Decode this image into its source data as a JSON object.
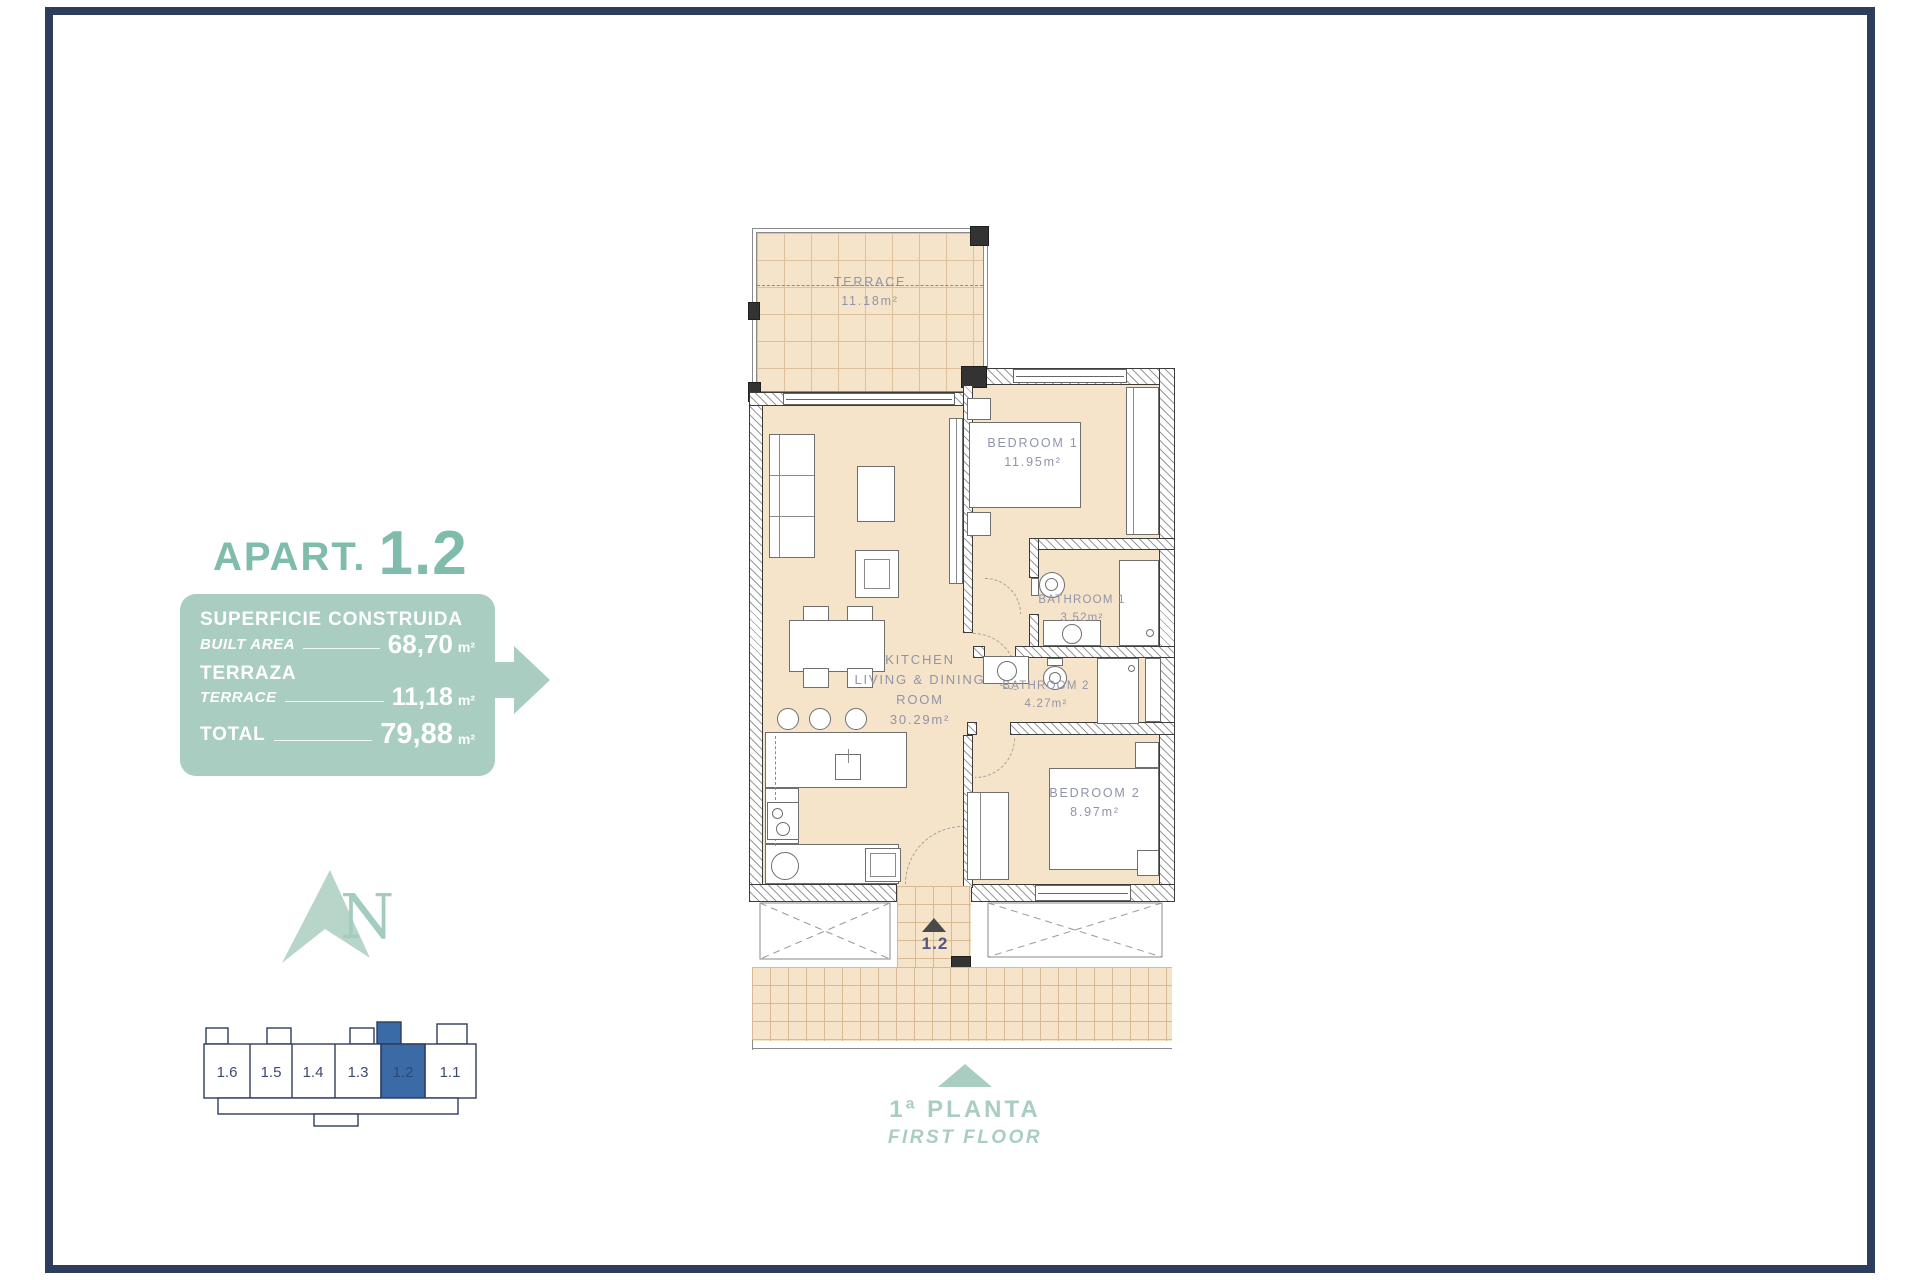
{
  "header": {
    "title_prefix": "APART.",
    "title_number": "1.2"
  },
  "area_box": {
    "rows": [
      {
        "label_primary": "SUPERFICIE CONSTRUIDA",
        "label_secondary": "BUILT AREA",
        "value": "68,70",
        "unit": "m²"
      },
      {
        "label_primary": "TERRAZA",
        "label_secondary": "TERRACE",
        "value": "11,18",
        "unit": "m²"
      },
      {
        "label_primary": "TOTAL",
        "value": "79,88",
        "unit": "m²"
      }
    ]
  },
  "compass": {
    "letter": "N"
  },
  "locator": {
    "units": [
      "1.6",
      "1.5",
      "1.4",
      "1.3",
      "1.2",
      "1.1"
    ],
    "highlighted_unit": "1.2"
  },
  "plan": {
    "terrace": {
      "name": "TERRACE",
      "area": "11.18m²"
    },
    "bedroom1": {
      "name": "BEDROOM 1",
      "area": "11.95m²"
    },
    "bathroom1": {
      "name": "BATHROOM 1",
      "area": "3.52m²"
    },
    "bathroom2": {
      "name": "BATHROOM 2",
      "area": "4.27m²"
    },
    "bedroom2": {
      "name": "BEDROOM 2",
      "area": "8.97m²"
    },
    "kitchen": {
      "line1": "KITCHEN",
      "line2": "LIVING & DINING",
      "line3": "ROOM",
      "area": "30.29m²"
    },
    "entrance_label": "1.2"
  },
  "floor_label": {
    "primary": "1ª PLANTA",
    "secondary": "FIRST FLOOR"
  },
  "colors": {
    "accent_green": "#7fbcab",
    "box_green": "#a9cec1",
    "highlight_blue": "#3b6ba6",
    "frame_navy": "#2e3d5c",
    "floor_beige": "#f6e4ca",
    "plan_label_gray": "#9094a8"
  }
}
